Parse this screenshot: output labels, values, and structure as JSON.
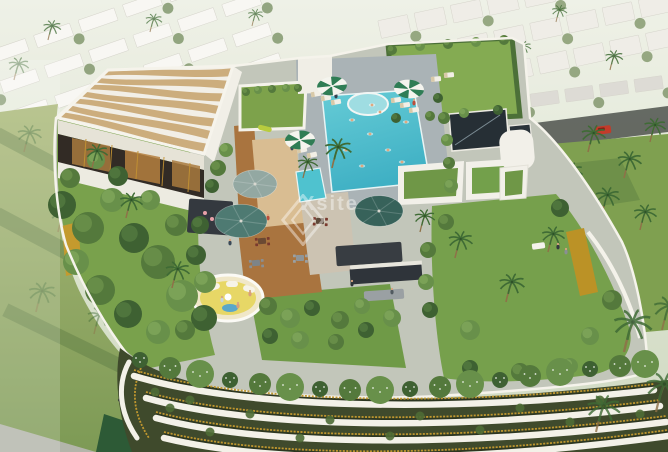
{
  "meta": {
    "type": "architectural-aerial-render",
    "description": "Aerial 3D rendering of a residential tower rooftop amenity deck with swimming pool, wavy-canopy pergola lounge, lawns, palm trees and umbrellas; white villa community, roads and palm groves surround the tower; curved white balcony slabs with gold railings form the facade below."
  },
  "watermark": {
    "text": "Xsite",
    "logo_icon": "diamond-outline-icon"
  },
  "colors": {
    "sky_haze": "#e7ecdf",
    "lawn": "#76a04c",
    "lawn_dark": "#4c7038",
    "pool": "#4fc2cf",
    "pool_light": "#9fdde2",
    "pool_deck": "#aab3b6",
    "deck_wood": "#a9743f",
    "sand_deck": "#d9bd92",
    "paver": "#c2c6ba",
    "canopy_tan": "#c9a977",
    "white_structure": "#f3f1e8",
    "gold": "#c0972f",
    "umbrella_green": "#2f7d55",
    "umbrella_teal": "#4e7a72",
    "tower_dark": "#3f4a2c",
    "kitchen_dark": "#383d42",
    "car_red": "#c23b2a",
    "lounge_yellow": "#e7d766"
  },
  "scene": {
    "palms": {
      "background": [
        [
          48,
          40,
          0.7,
          0.75
        ],
        [
          150,
          32,
          0.65,
          0.7
        ],
        [
          252,
          26,
          0.6,
          0.7
        ],
        [
          556,
          22,
          0.6,
          0.75
        ],
        [
          610,
          70,
          0.7,
          0.85
        ],
        [
          520,
          58,
          0.6,
          0.8
        ]
      ],
      "right_grove": [
        [
          588,
          152,
          0.95,
          1
        ],
        [
          624,
          178,
          0.95,
          1
        ],
        [
          650,
          142,
          0.85,
          1
        ],
        [
          566,
          188,
          0.9,
          1
        ],
        [
          602,
          214,
          0.95,
          1
        ],
        [
          640,
          230,
          0.9,
          1
        ]
      ],
      "left_faded": [
        [
          24,
          152,
          0.95,
          0.45
        ],
        [
          58,
          232,
          1.05,
          0.45
        ],
        [
          36,
          312,
          1.05,
          0.4
        ],
        [
          94,
          334,
          0.95,
          0.45
        ],
        [
          140,
          262,
          0.85,
          0.5
        ],
        [
          14,
          80,
          0.8,
          0.5
        ]
      ],
      "rooftop": [
        [
          92,
          168,
          0.85,
          1
        ],
        [
          126,
          218,
          0.9,
          1
        ],
        [
          172,
          288,
          0.95,
          1
        ],
        [
          332,
          168,
          1.05,
          1
        ],
        [
          303,
          178,
          0.8,
          1
        ],
        [
          455,
          258,
          0.95,
          1
        ],
        [
          506,
          302,
          1,
          1
        ],
        [
          548,
          252,
          0.9,
          1
        ],
        [
          420,
          232,
          0.8,
          1
        ]
      ],
      "foreground": [
        [
          624,
          352,
          1.5,
          0.85
        ],
        [
          656,
          412,
          1.4,
          0.8
        ],
        [
          596,
          432,
          1.3,
          0.8
        ],
        [
          662,
          330,
          1.2,
          0.8
        ]
      ]
    },
    "bushes": [
      [
        62,
        205,
        14,
        0
      ],
      [
        88,
        228,
        16,
        1
      ],
      [
        112,
        200,
        12,
        2
      ],
      [
        134,
        238,
        15,
        0
      ],
      [
        158,
        262,
        17,
        1
      ],
      [
        182,
        296,
        16,
        2
      ],
      [
        204,
        318,
        13,
        0
      ],
      [
        76,
        262,
        13,
        2
      ],
      [
        100,
        290,
        15,
        1
      ],
      [
        128,
        314,
        14,
        0
      ],
      [
        158,
        332,
        12,
        2
      ],
      [
        70,
        178,
        10,
        1
      ],
      [
        96,
        160,
        9,
        2
      ],
      [
        118,
        176,
        10,
        0
      ],
      [
        185,
        330,
        10,
        1
      ],
      [
        205,
        282,
        11,
        2
      ],
      [
        196,
        255,
        10,
        0
      ],
      [
        176,
        225,
        11,
        1
      ],
      [
        150,
        200,
        10,
        2
      ],
      [
        200,
        225,
        9,
        0
      ],
      [
        218,
        168,
        8,
        1
      ],
      [
        226,
        150,
        7,
        2
      ],
      [
        212,
        186,
        7,
        0
      ],
      [
        268,
        306,
        9,
        1
      ],
      [
        290,
        318,
        10,
        2
      ],
      [
        312,
        308,
        8,
        0
      ],
      [
        340,
        320,
        9,
        1
      ],
      [
        362,
        306,
        8,
        2
      ],
      [
        270,
        336,
        8,
        0
      ],
      [
        300,
        340,
        9,
        2
      ],
      [
        336,
        342,
        8,
        1
      ],
      [
        366,
        330,
        8,
        0
      ],
      [
        392,
        318,
        9,
        2
      ],
      [
        446,
        222,
        8,
        1
      ],
      [
        470,
        330,
        10,
        2
      ],
      [
        560,
        208,
        9,
        0
      ],
      [
        612,
        300,
        10,
        1
      ],
      [
        590,
        336,
        9,
        2
      ],
      [
        470,
        368,
        8,
        0
      ],
      [
        520,
        372,
        9,
        1
      ],
      [
        570,
        366,
        8,
        2
      ],
      [
        444,
        118,
        6,
        1
      ],
      [
        447,
        140,
        6,
        2
      ],
      [
        449,
        163,
        6,
        1
      ],
      [
        451,
        186,
        7,
        2
      ],
      [
        438,
        98,
        5,
        0
      ],
      [
        392,
        50,
        5,
        1
      ],
      [
        420,
        46,
        5,
        2
      ],
      [
        448,
        44,
        5,
        1
      ],
      [
        476,
        42,
        5,
        2
      ],
      [
        504,
        40,
        5,
        1
      ],
      [
        396,
        118,
        5,
        0
      ],
      [
        430,
        116,
        5,
        1
      ],
      [
        464,
        113,
        5,
        2
      ],
      [
        498,
        110,
        5,
        0
      ],
      [
        428,
        250,
        8,
        1
      ],
      [
        426,
        282,
        8,
        2
      ],
      [
        430,
        310,
        8,
        0
      ],
      [
        246,
        92,
        4,
        1
      ],
      [
        258,
        90,
        4,
        2
      ],
      [
        272,
        89,
        4,
        1
      ],
      [
        286,
        88,
        4,
        2
      ],
      [
        298,
        88,
        4,
        1
      ]
    ],
    "edge_planting_row": [
      [
        140,
        360
      ],
      [
        170,
        368
      ],
      [
        200,
        374
      ],
      [
        230,
        380
      ],
      [
        260,
        384
      ],
      [
        290,
        387
      ],
      [
        320,
        389
      ],
      [
        350,
        390
      ],
      [
        380,
        390
      ],
      [
        410,
        389
      ],
      [
        440,
        387
      ],
      [
        470,
        384
      ],
      [
        500,
        380
      ],
      [
        530,
        376
      ],
      [
        560,
        372
      ],
      [
        590,
        369
      ],
      [
        620,
        366
      ],
      [
        645,
        364
      ]
    ],
    "balcony_plants": [
      [
        190,
        400
      ],
      [
        250,
        414
      ],
      [
        330,
        420
      ],
      [
        420,
        416
      ],
      [
        520,
        408
      ],
      [
        600,
        400
      ],
      [
        210,
        432
      ],
      [
        300,
        438
      ],
      [
        390,
        436
      ],
      [
        480,
        430
      ],
      [
        570,
        422
      ],
      [
        640,
        414
      ],
      [
        170,
        408
      ],
      [
        155,
        392
      ]
    ],
    "striped_umbrellas": [
      [
        332,
        86,
        -6
      ],
      [
        409,
        89,
        5
      ],
      [
        300,
        140,
        -4
      ]
    ],
    "canvas_umbrellas": [
      [
        255,
        184,
        22,
        "#93a8a2"
      ],
      [
        241,
        221,
        26,
        "#4e7a72"
      ],
      [
        379,
        211,
        24,
        "#37625a"
      ]
    ],
    "loungers": [
      [
        316,
        94,
        -10
      ],
      [
        326,
        98,
        -10
      ],
      [
        336,
        102,
        -10
      ],
      [
        396,
        100,
        -8
      ],
      [
        405,
        105,
        -8
      ],
      [
        414,
        110,
        -8
      ],
      [
        436,
        79,
        -5
      ],
      [
        449,
        75,
        -5
      ],
      [
        302,
        150,
        -12
      ],
      [
        312,
        155,
        -12
      ]
    ],
    "people": [
      [
        230,
        243,
        "#3a4a58"
      ],
      [
        268,
        218,
        "#b94f3c"
      ],
      [
        352,
        284,
        "#2e3338"
      ],
      [
        392,
        292,
        "#515a60"
      ],
      [
        558,
        247,
        "#33383d"
      ],
      [
        566,
        252,
        "#8a8f93"
      ],
      [
        336,
        96,
        "#334150"
      ],
      [
        414,
        103,
        "#b94f3c"
      ],
      [
        292,
        148,
        "#3c4c5a"
      ],
      [
        222,
        300,
        "#c8d2d8"
      ],
      [
        238,
        306,
        "#d9a079"
      ],
      [
        250,
        294,
        "#d9a079"
      ]
    ],
    "pool_people": [
      [
        352,
        120
      ],
      [
        370,
        134
      ],
      [
        388,
        150
      ],
      [
        402,
        162
      ],
      [
        346,
        150
      ],
      [
        362,
        166
      ],
      [
        406,
        122
      ],
      [
        380,
        112
      ],
      [
        372,
        105
      ]
    ],
    "dining_sets": [
      [
        262,
        241,
        -4,
        "#7a3a2e",
        "#6b4a33"
      ],
      [
        320,
        221,
        3,
        "#7a3a2e",
        "#5d4a3a"
      ],
      [
        256,
        263,
        -4,
        "#8a8f93",
        "#7d8488"
      ],
      [
        300,
        258,
        0,
        "#9aa0a3",
        "#8f9598"
      ]
    ],
    "villas": {
      "top_left": {
        "rotate": "-19 130 70",
        "rows": [
          6,
          38,
          70,
          102
        ],
        "x0": -44,
        "count": 7,
        "w": 38,
        "h": 13,
        "gap": 9,
        "fill": "#f7f6f1",
        "tree": "#5d7a44"
      },
      "top_right": {
        "rotate": "-12 520 55",
        "rows": [
          -8,
          26,
          60
        ],
        "x0": 388,
        "count": 8,
        "w": 30,
        "h": 18,
        "gap": 7,
        "fill": "#edebe3",
        "tree": "#637e47"
      },
      "mid_right": {
        "rotate": "-8 560 100",
        "rows": [
          90
        ],
        "x0": 496,
        "count": 6,
        "w": 28,
        "h": 13,
        "gap": 7,
        "fill": "#d8d6ce",
        "tree": "#5d7a44"
      }
    },
    "canopy": {
      "tl": [
        108,
        70
      ],
      "tr": [
        233,
        66
      ],
      "bl": [
        58,
        118
      ],
      "br": [
        204,
        154
      ],
      "stripes": 7
    }
  }
}
